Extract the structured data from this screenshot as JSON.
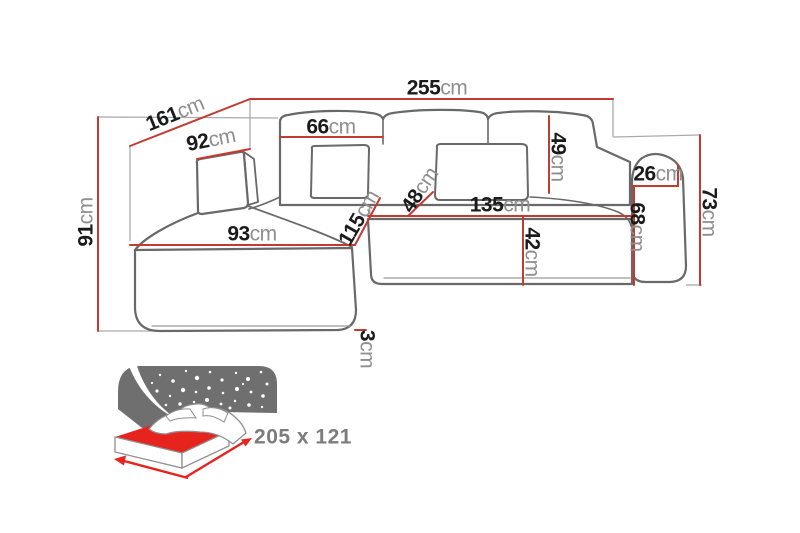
{
  "diagram": {
    "title": "corner-sofa-dimension-diagram",
    "dims": {
      "d255": {
        "value": "255",
        "unit": "cm"
      },
      "d161": {
        "value": "161",
        "unit": "cm"
      },
      "d92": {
        "value": "92",
        "unit": "cm"
      },
      "d91": {
        "value": "91",
        "unit": "cm"
      },
      "d66": {
        "value": "66",
        "unit": "cm"
      },
      "d49": {
        "value": "49",
        "unit": "cm"
      },
      "d26": {
        "value": "26",
        "unit": "cm"
      },
      "d73": {
        "value": "73",
        "unit": "cm"
      },
      "d68": {
        "value": "68",
        "unit": "cm"
      },
      "d135": {
        "value": "135",
        "unit": "cm"
      },
      "d48": {
        "value": "48",
        "unit": "cm"
      },
      "d115": {
        "value": "115",
        "unit": "cm"
      },
      "d42": {
        "value": "42",
        "unit": "cm"
      },
      "d93": {
        "value": "93",
        "unit": "cm"
      },
      "d3": {
        "value": "3",
        "unit": "cm"
      }
    },
    "bed_icon": {
      "sleeping_area_label": "205 x 121"
    },
    "colors": {
      "dimension_line": "#c43a31",
      "dimension_value_text": "#1b1b1b",
      "dimension_unit_text": "#8f8f8f",
      "sofa_outline": "#696969",
      "extension_line": "#ababab",
      "bed_accent_red": "#e6231c",
      "night_sky_gray": "#6f6f6f",
      "sleeping_label_text": "#7c7c7c",
      "background": "#ffffff"
    }
  }
}
